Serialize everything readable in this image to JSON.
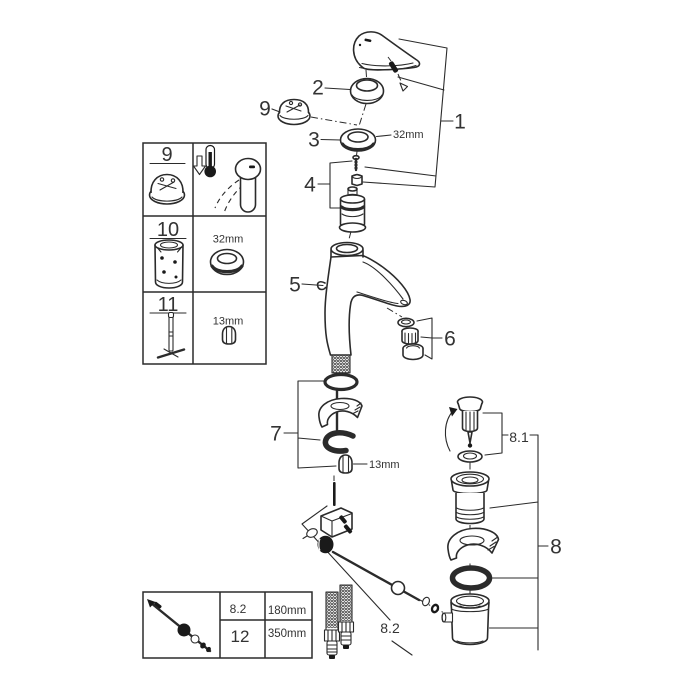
{
  "page": {
    "background": "#ffffff",
    "line_color": "#2b2b2b",
    "accent_dark": "#1a1a1a",
    "label_color": "#333333"
  },
  "callouts": {
    "n1": "1",
    "n2": "2",
    "n3": "3",
    "n4": "4",
    "n5": "5",
    "n6": "6",
    "n7": "7",
    "n8": "8",
    "n8_1": "8.1",
    "n8_2": "8.2",
    "n9": "9"
  },
  "dimensions": {
    "cap_ring": "32mm",
    "mounting_nut": "13mm"
  },
  "parts_table": {
    "row9_num": "9",
    "row10_num": "10",
    "row10_dim": "32mm",
    "row11_num": "11",
    "row11_dim": "13mm"
  },
  "hose_table": {
    "row1_num": "8.2",
    "row1_len": "180mm",
    "row2_num": "12",
    "row2_len": "350mm"
  }
}
